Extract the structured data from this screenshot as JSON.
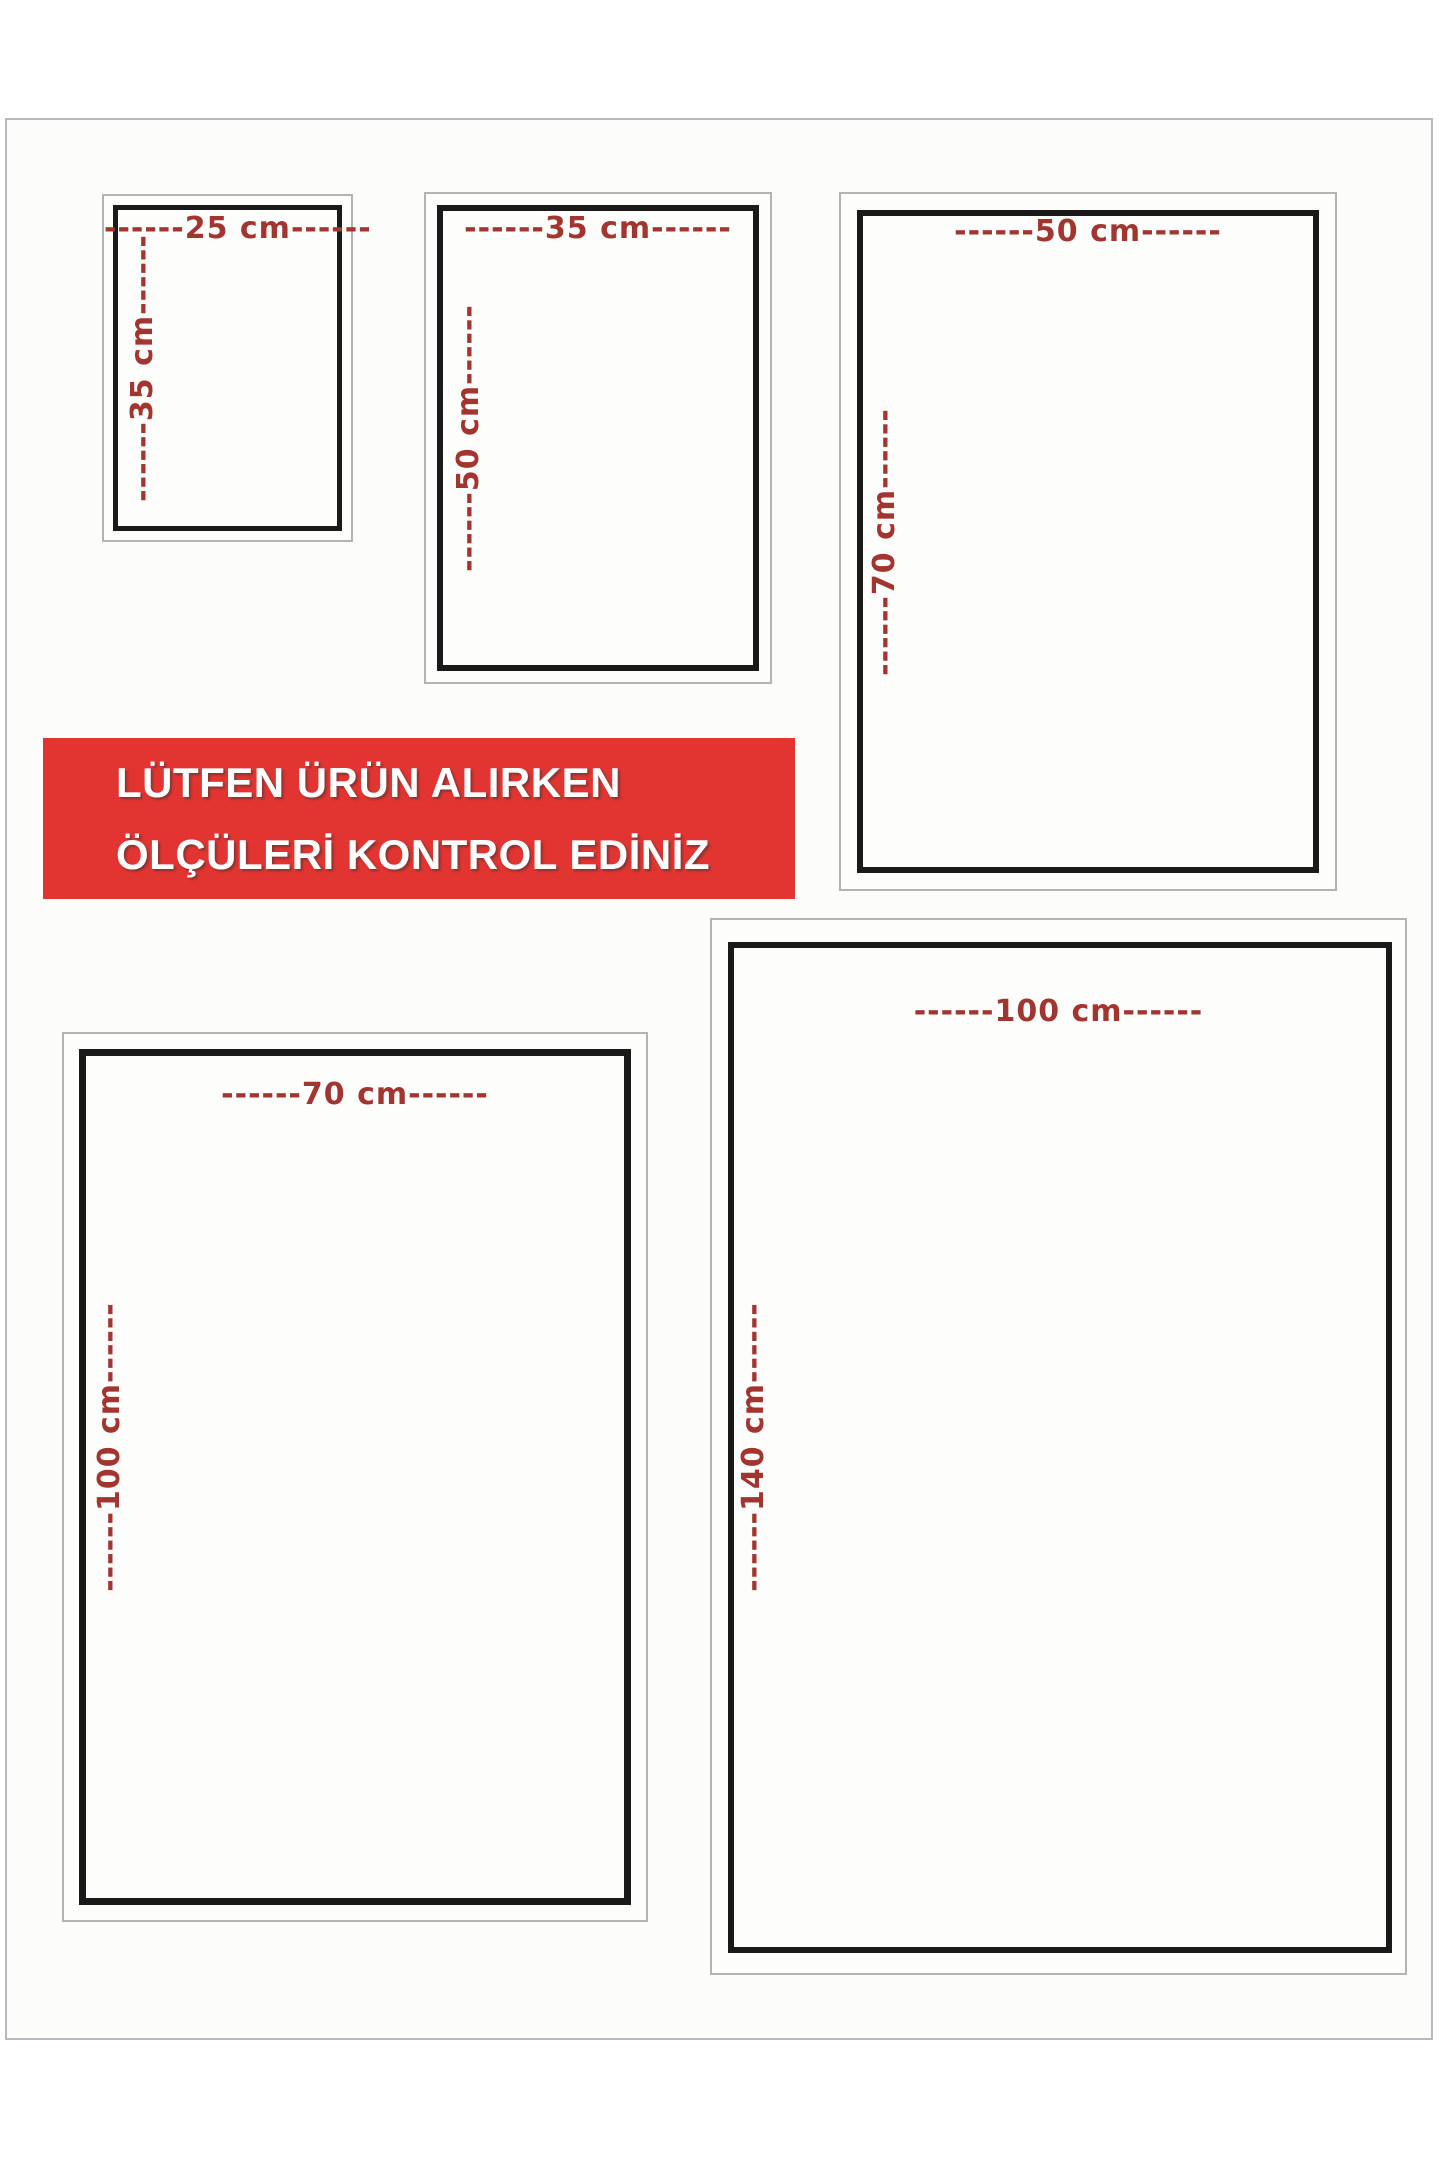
{
  "notice_banner": {
    "line1": "LÜTFEN ÜRÜN ALIRKEN",
    "line2": "ÖLÇÜLERİ KONTROL EDİNİZ",
    "background_color": "#e23430",
    "text_color": "#ffffff"
  },
  "style": {
    "dimension_label_color": "#a23530",
    "inner_frame_color": "#1a1a1a",
    "outer_frame_color": "#b3b3b3",
    "page_background": "#fcfcfa"
  },
  "size_boxes": [
    {
      "name": "25x35-cm",
      "width_cm": 25,
      "height_cm": 35,
      "width_label": "------25 cm------",
      "height_label": "------35 cm------"
    },
    {
      "name": "35x50-cm",
      "width_cm": 35,
      "height_cm": 50,
      "width_label": "------35 cm------",
      "height_label": "------50 cm------"
    },
    {
      "name": "50x70-cm",
      "width_cm": 50,
      "height_cm": 70,
      "width_label": "------50 cm------",
      "height_label": "------70 cm------"
    },
    {
      "name": "70x100-cm",
      "width_cm": 70,
      "height_cm": 100,
      "width_label": "------70 cm------",
      "height_label": "------100 cm------"
    },
    {
      "name": "100x140-cm",
      "width_cm": 100,
      "height_cm": 140,
      "width_label": "------100 cm------",
      "height_label": "------140 cm------"
    }
  ]
}
